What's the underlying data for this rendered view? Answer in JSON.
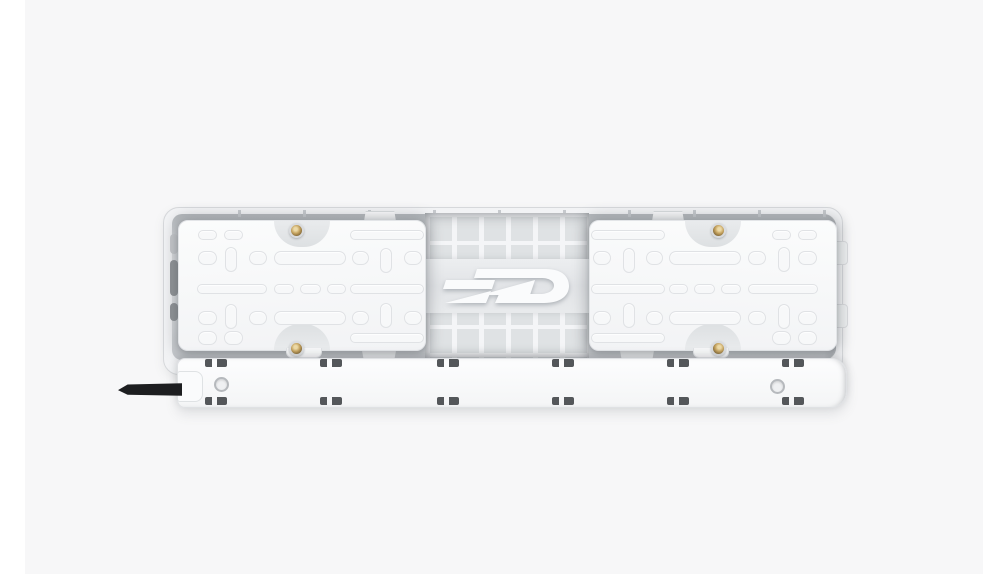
{
  "scene": {
    "type": "product-photo",
    "description": "Rear mounting-side view of a white power strip with two slotted mounting plates, brass screws, a clip rail and a black power cable stub",
    "background_color": "#f7f7f8",
    "side_margin_color": "#ffffff"
  },
  "product": {
    "title": "Power strip rear panel",
    "logo_text": "SSD",
    "mounting_plate_count": 2,
    "screw_count": 4,
    "rail_clip_count": 12,
    "screw_hole_count": 2,
    "colors": {
      "shell": "#f2f3f5",
      "recess": "#c9ccd0",
      "plate": "#f9fafb",
      "grid_rib": "#f4f5f7",
      "grid_cell": "#dfe2e4",
      "rail": "#fbfcfd",
      "clip": "#54575a",
      "screw_brass": "#bb9a5c",
      "cable": "#1d1e20",
      "logo_fill": "#fafbfc"
    }
  }
}
